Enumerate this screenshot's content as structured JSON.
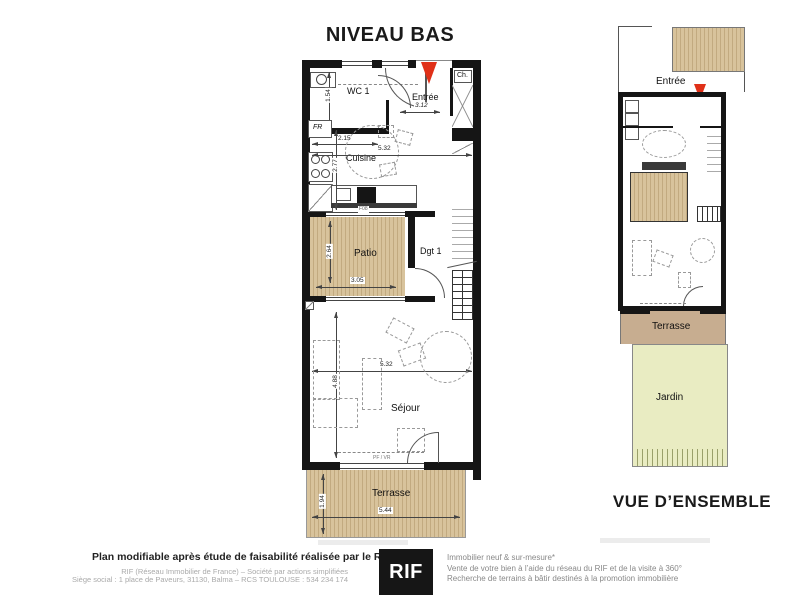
{
  "titles": {
    "main_plan": "NIVEAU BAS",
    "overview": "VUE D’ENSEMBLE"
  },
  "main_plan": {
    "rooms": {
      "wc": "WC 1",
      "entree": "Entrée",
      "cuisine": "Cuisine",
      "patio": "Patio",
      "dgt": "Dgt 1",
      "sejour": "Séjour",
      "terrasse": "Terrasse"
    },
    "fixtures": {
      "fridge": "FR",
      "closet": "Ch."
    },
    "dims": {
      "wc_h": "1.54",
      "wc_w": "2.15",
      "entree_w": "3.12",
      "cuisine_w": "5.32",
      "cuisine_h": "2.77",
      "patio_window": "F08",
      "patio_w": "3.05",
      "patio_h": "2.64",
      "sejour_w": "5.32",
      "sejour_h": "4.88",
      "bay_label": "PF / VR",
      "terrasse_w": "5.44",
      "terrasse_h": "1.94"
    }
  },
  "overview": {
    "entree": "Entrée",
    "terrasse": "Terrasse",
    "jardin": "Jardin"
  },
  "footer": {
    "bold_line": "Plan modifiable après étude de faisabilité réalisée par le RIF",
    "legal_line1": "RIF (Réseau Immobilier de France) – Société par actions simplifiées",
    "legal_line2": "Siège social : 1 place de Paveurs, 31130, Balma – RCS TOULOUSE : 534 234 174",
    "logo_text": "RIF",
    "services": [
      "Immobilier neuf & sur-mesure*",
      "Vente de votre bien à l’aide du réseau du RIF et de la visite à 360°",
      "Recherche de terrains à bâtir destinés à la promotion immobilière"
    ]
  },
  "colors": {
    "wall": "#151515",
    "wood": "#d8c39c",
    "wood_stripe": "#c2aa80",
    "terrace_overview": "#c7ad90",
    "garden": "#e9ecc2",
    "arrow_red": "#e03018"
  }
}
